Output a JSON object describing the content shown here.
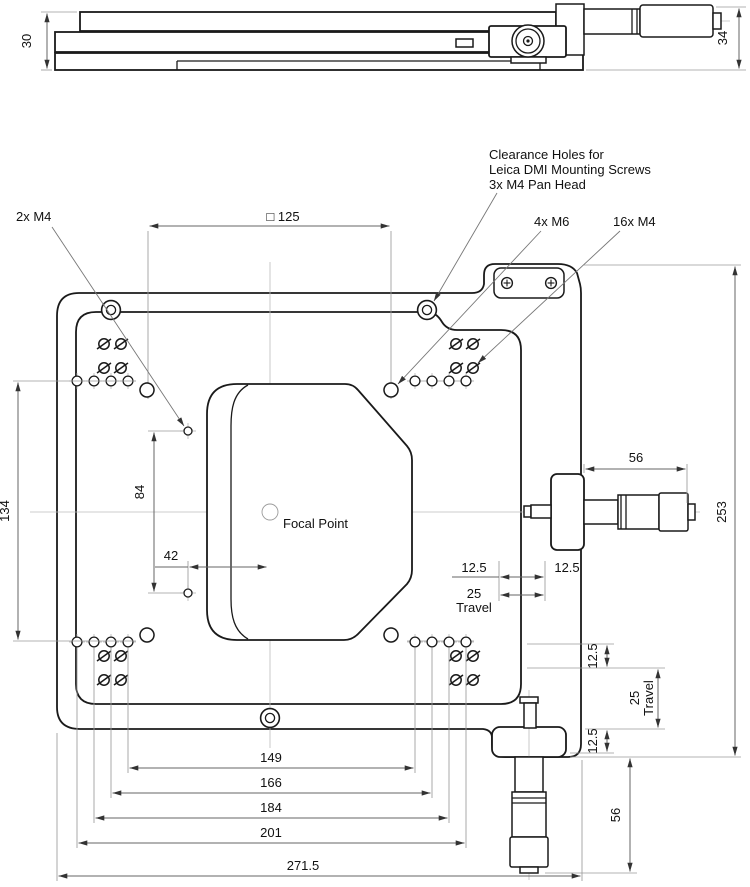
{
  "side_view": {
    "height_stage": "30",
    "height_overall": "34"
  },
  "plan_view": {
    "labels": {
      "m4_pair": "2x M4",
      "square_pattern": "□ 125",
      "clearance_1": "Clearance Holes for",
      "clearance_2": "Leica DMI Mounting Screws",
      "clearance_3": "3x M4 Pan Head",
      "m6_count": "4x M6",
      "m4_count": "16x M4",
      "focal_point": "Focal Point"
    },
    "dims": {
      "plate_span": "134",
      "m4_pair_span": "84",
      "m4_offset": "42",
      "x_mic_len": "56",
      "overall": "253",
      "x_left": "12.5",
      "x_right": "12.5",
      "x_amount": "25",
      "x_word": "Travel",
      "y_upper": "12.5",
      "y_lower": "12.5",
      "y_amount": "25",
      "y_word": "Travel",
      "y_mic_len": "56",
      "chain": [
        "149",
        "166",
        "184",
        "201",
        "271.5"
      ]
    }
  }
}
